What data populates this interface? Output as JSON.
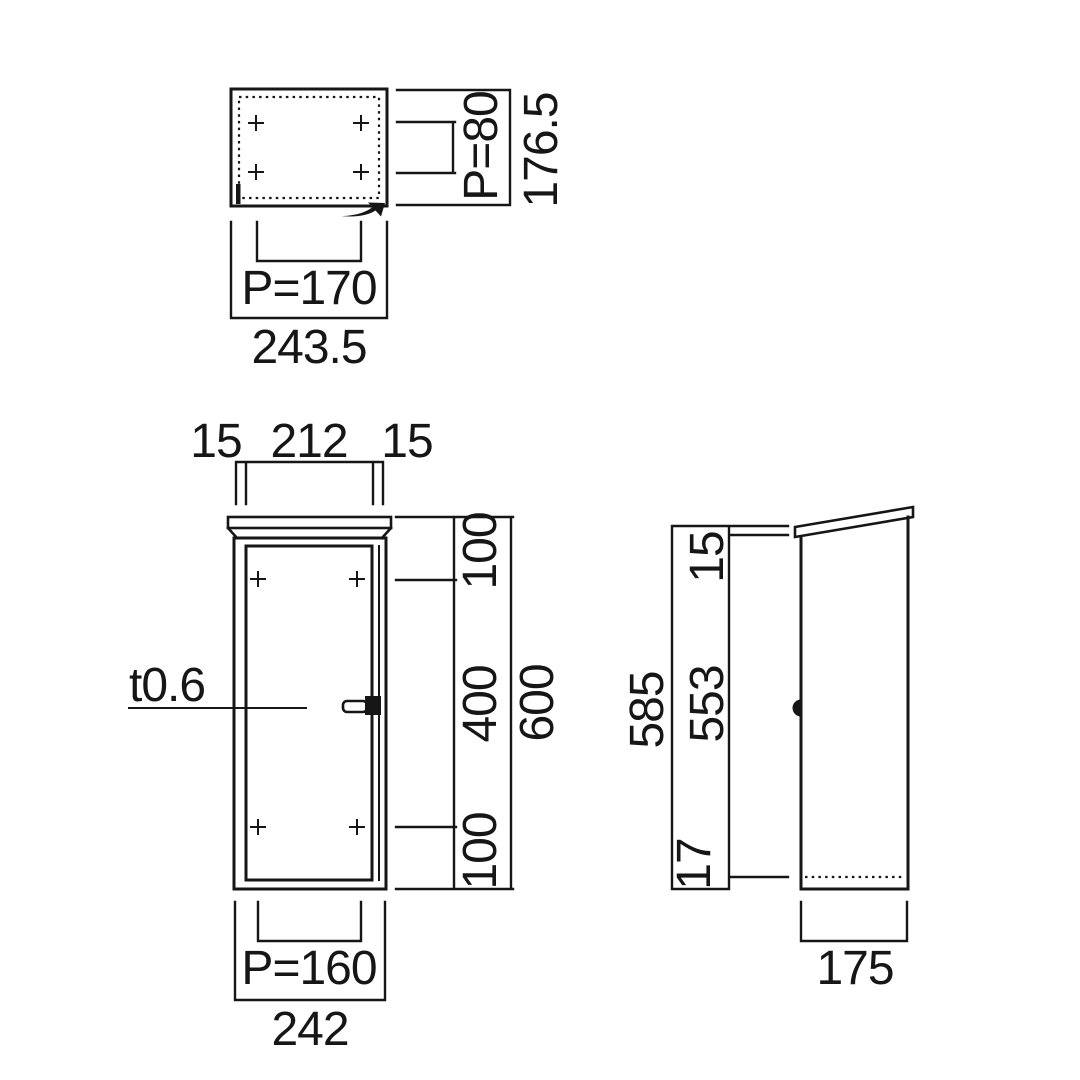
{
  "colors": {
    "ink": "#161616",
    "background": "#ffffff"
  },
  "plan": {
    "pitch_width": "P=170",
    "overall_width": "243.5",
    "pitch_depth": "P=80",
    "overall_depth": "176.5"
  },
  "front": {
    "margin_left": "15",
    "opening_width": "212",
    "margin_right": "15",
    "thickness_note": "t0.6",
    "hole_top_offset": "100",
    "hole_span": "400",
    "hole_bottom_offset": "100",
    "body_height": "600",
    "pitch_width": "P=160",
    "overall_width": "242"
  },
  "side": {
    "overall_height": "585",
    "door_height": "553",
    "top_cap": "15",
    "bottom_inset": "17",
    "depth": "175"
  }
}
